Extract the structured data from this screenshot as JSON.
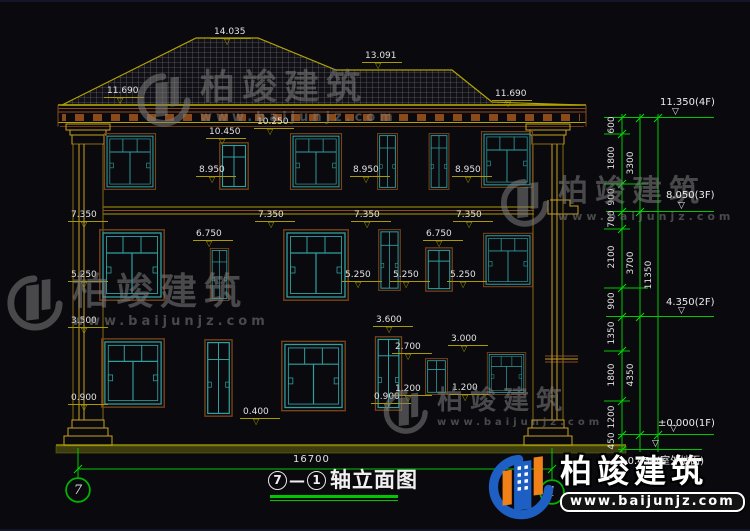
{
  "colors": {
    "background": "#0a0a0e",
    "cad_green": "#00c800",
    "olive": "#a89a00",
    "roof_yellow": "#b4a400",
    "window_teal": "#2fa0a0",
    "frame_brown": "#7a4318",
    "pilaster_yellow": "#c8a020",
    "text_white": "#e2e2e2",
    "logo_blue": "#1d5fc2",
    "logo_orange": "#f08018",
    "watermark_gray": "#7d7d7d"
  },
  "title": {
    "axis_start": "7",
    "dash": "—",
    "axis_end": "1",
    "text": "轴立面图"
  },
  "axis_bubbles": [
    {
      "label": "7",
      "x": 66,
      "y": 476
    },
    {
      "label": "1",
      "x": 540,
      "y": 478
    }
  ],
  "dims": {
    "bottom_total": "16700",
    "inner": [
      {
        "t": "600",
        "y": 124
      },
      {
        "t": "1800",
        "y": 157
      },
      {
        "t": "900",
        "y": 196
      },
      {
        "t": "700",
        "y": 218
      },
      {
        "t": "2100",
        "y": 256
      },
      {
        "t": "900",
        "y": 300
      },
      {
        "t": "1350",
        "y": 332
      },
      {
        "t": "1800",
        "y": 374
      },
      {
        "t": "1200",
        "y": 416
      },
      {
        "t": "450",
        "y": 440
      }
    ],
    "outer": [
      {
        "t": "3300",
        "y": 162
      },
      {
        "t": "3700",
        "y": 262
      },
      {
        "t": "4350",
        "y": 374
      }
    ],
    "total": [
      {
        "t": "11350",
        "y": 274
      }
    ]
  },
  "floor_labels": [
    {
      "t": "11.350(4F)",
      "tx": 660,
      "ty": 95,
      "lx": 646,
      "ly": 115,
      "lw": 68,
      "trix": 672,
      "triy": 106
    },
    {
      "t": "8.050(3F)",
      "tx": 666,
      "ty": 188,
      "lx": 650,
      "ly": 209,
      "lw": 64,
      "trix": 678,
      "triy": 200
    },
    {
      "t": "4.350(2F)",
      "tx": 666,
      "ty": 295,
      "lx": 650,
      "ly": 314,
      "lw": 64,
      "trix": 678,
      "triy": 305
    },
    {
      "t": "±0.000(1F)",
      "tx": 658,
      "ty": 416,
      "lx": 620,
      "ly": 432,
      "lw": 94,
      "trix": 670,
      "triy": 423
    },
    {
      "t": "-0.450(室外地面)",
      "tx": 624,
      "ty": 450,
      "lx": 620,
      "ly": 447,
      "lw": 82,
      "trix": 652,
      "triy": 438
    }
  ],
  "elevation_marks": [
    {
      "t": "11.690",
      "x": 104,
      "y": 84
    },
    {
      "t": "14.035",
      "x": 211,
      "y": 25
    },
    {
      "t": "13.091",
      "x": 362,
      "y": 49
    },
    {
      "t": "11.690",
      "x": 492,
      "y": 87
    },
    {
      "t": "10.450",
      "x": 206,
      "y": 125
    },
    {
      "t": "10.250",
      "x": 254,
      "y": 115
    },
    {
      "t": "8.950",
      "x": 196,
      "y": 163
    },
    {
      "t": "8.950",
      "x": 350,
      "y": 163
    },
    {
      "t": "8.950",
      "x": 452,
      "y": 163
    },
    {
      "t": "7.350",
      "x": 68,
      "y": 208
    },
    {
      "t": "7.350",
      "x": 255,
      "y": 208
    },
    {
      "t": "7.350",
      "x": 351,
      "y": 208
    },
    {
      "t": "7.350",
      "x": 453,
      "y": 208
    },
    {
      "t": "6.750",
      "x": 193,
      "y": 227
    },
    {
      "t": "6.750",
      "x": 423,
      "y": 227
    },
    {
      "t": "5.250",
      "x": 68,
      "y": 268
    },
    {
      "t": "5.250",
      "x": 342,
      "y": 268
    },
    {
      "t": "5.250",
      "x": 390,
      "y": 268
    },
    {
      "t": "5.250",
      "x": 447,
      "y": 268
    },
    {
      "t": "3.500",
      "x": 68,
      "y": 314
    },
    {
      "t": "3.600",
      "x": 373,
      "y": 313
    },
    {
      "t": "2.700",
      "x": 392,
      "y": 340
    },
    {
      "t": "3.000",
      "x": 448,
      "y": 332
    },
    {
      "t": "1.200",
      "x": 392,
      "y": 382
    },
    {
      "t": "1.200",
      "x": 449,
      "y": 381
    },
    {
      "t": "0.900",
      "x": 68,
      "y": 391
    },
    {
      "t": "0.900",
      "x": 371,
      "y": 390
    },
    {
      "t": "0.400",
      "x": 240,
      "y": 405
    }
  ],
  "watermarks": [
    {
      "text": "柏竣建筑",
      "url": "www.baijunjz.com",
      "x": 134,
      "y": 68,
      "glyph": 58,
      "text_size": 35,
      "url_size": 13
    },
    {
      "text": "柏竣建筑",
      "url": "www.baijunjz.com",
      "x": 498,
      "y": 174,
      "glyph": 52,
      "text_size": 30,
      "url_size": 11
    },
    {
      "text": "柏竣建筑",
      "url": "www.baijunjz.com",
      "x": 4,
      "y": 270,
      "glyph": 60,
      "text_size": 37,
      "url_size": 13
    },
    {
      "text": "柏竣建筑",
      "url": "www.baijunjz.com",
      "x": 381,
      "y": 385,
      "glyph": 48,
      "text_size": 26,
      "url_size": 10
    }
  ],
  "logo": {
    "name": "柏竣建筑",
    "url": "www.baijunjz.com"
  }
}
